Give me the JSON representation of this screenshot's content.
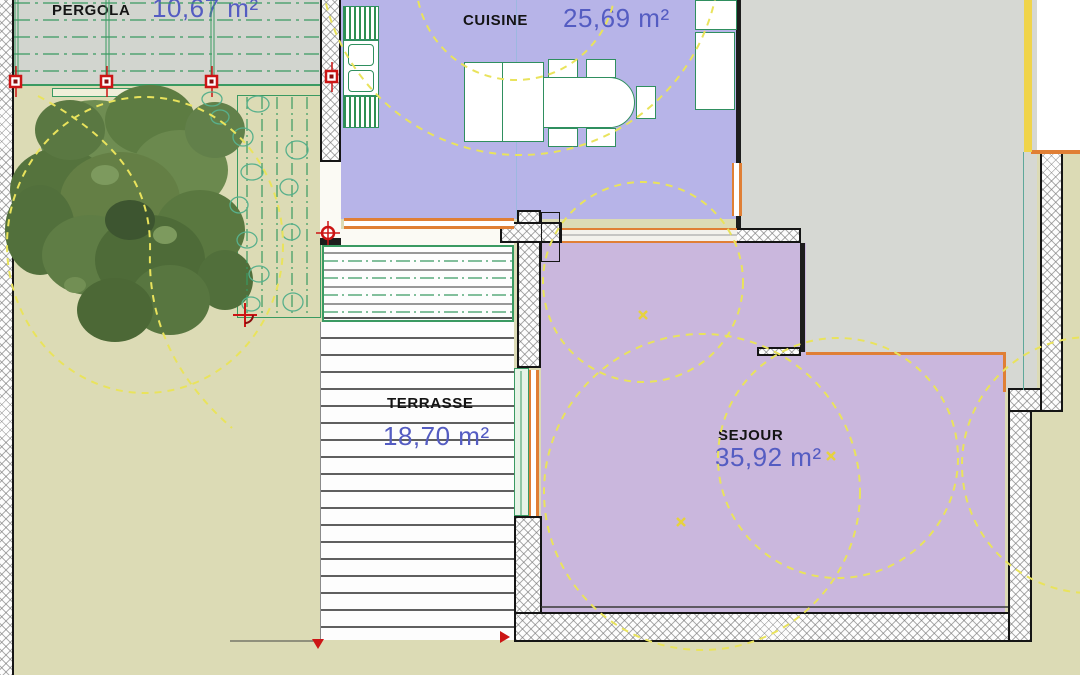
{
  "drawing": {
    "kind": "architectural-floor-plan",
    "rooms": [
      {
        "name": "PERGOLA",
        "area": "10,67 m²"
      },
      {
        "name": "CUISINE",
        "area": "25,69 m²"
      },
      {
        "name": "TERRASSE",
        "area": "18,70 m²"
      },
      {
        "name": "SEJOUR",
        "area": "35,92 m²"
      }
    ],
    "colors": {
      "cuisine_fill": "#b7b4e8",
      "sejour_fill": "#cab7dd",
      "gray_room_fill": "#d6d8d3",
      "pergola_fill": "#d2d5cf",
      "garden_fill": "#dcdbb5",
      "area_text": "#545cc2",
      "label_text": "#141414",
      "accent_orange": "#e07f35",
      "accent_green": "#3a9a62",
      "accent_yellow": "#e9e35c",
      "accent_red": "#cc1515"
    }
  }
}
